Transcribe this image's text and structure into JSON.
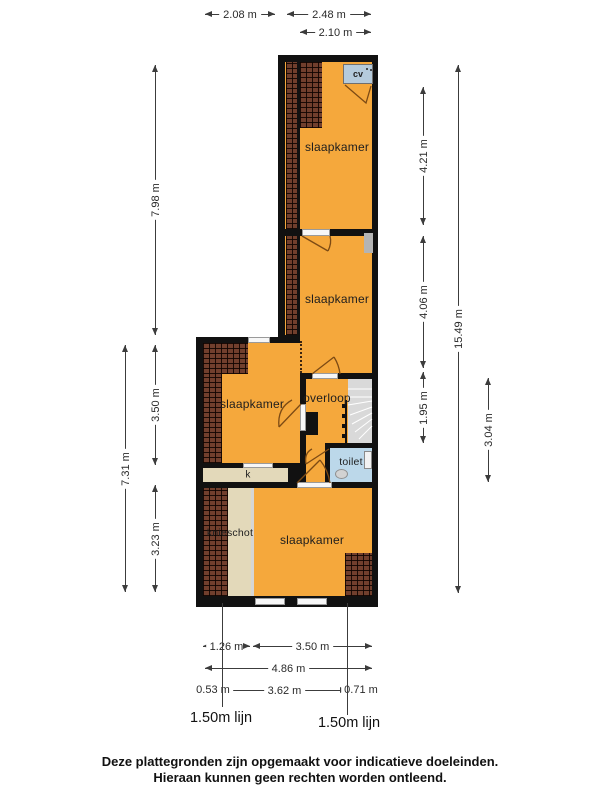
{
  "plan": {
    "rooms": {
      "slaapkamer_top": "slaapkamer",
      "slaapkamer_middle": "slaapkamer",
      "slaapkamer_left": "slaapkamer",
      "slaapkamer_bottom": "slaapkamer",
      "overloop": "overloop",
      "toilet": "toilet",
      "kast": "k",
      "knieschot": "knieschot",
      "cv_unit": "cv"
    },
    "dimensions": {
      "top": [
        "2.08 m",
        "2.48 m",
        "2.10 m"
      ],
      "left": [
        "7.98 m",
        "3.50 m",
        "3.23 m",
        "7.31 m"
      ],
      "right": [
        "4.21 m",
        "4.06 m",
        "1.95 m",
        "15.49 m",
        "3.04 m"
      ],
      "bottom": [
        "1.26 m",
        "3.50 m",
        "4.86 m",
        "0.53 m",
        "3.62 m",
        "0.71 m"
      ],
      "height_lines": [
        "1.50m lijn",
        "1.50m lijn"
      ]
    },
    "colors": {
      "floor": "#F5A83C",
      "wall": "#111111",
      "roof_hatch": "#713F2D",
      "knieschot_fill": "#E3D9BA",
      "toilet_fill": "#BCD8EA",
      "stairs": "#D9D9D9"
    }
  },
  "footer": {
    "line1": "Deze plattegronden zijn opgemaakt voor indicatieve doeleinden.",
    "line2": "Hieraan kunnen geen rechten worden ontleend."
  }
}
